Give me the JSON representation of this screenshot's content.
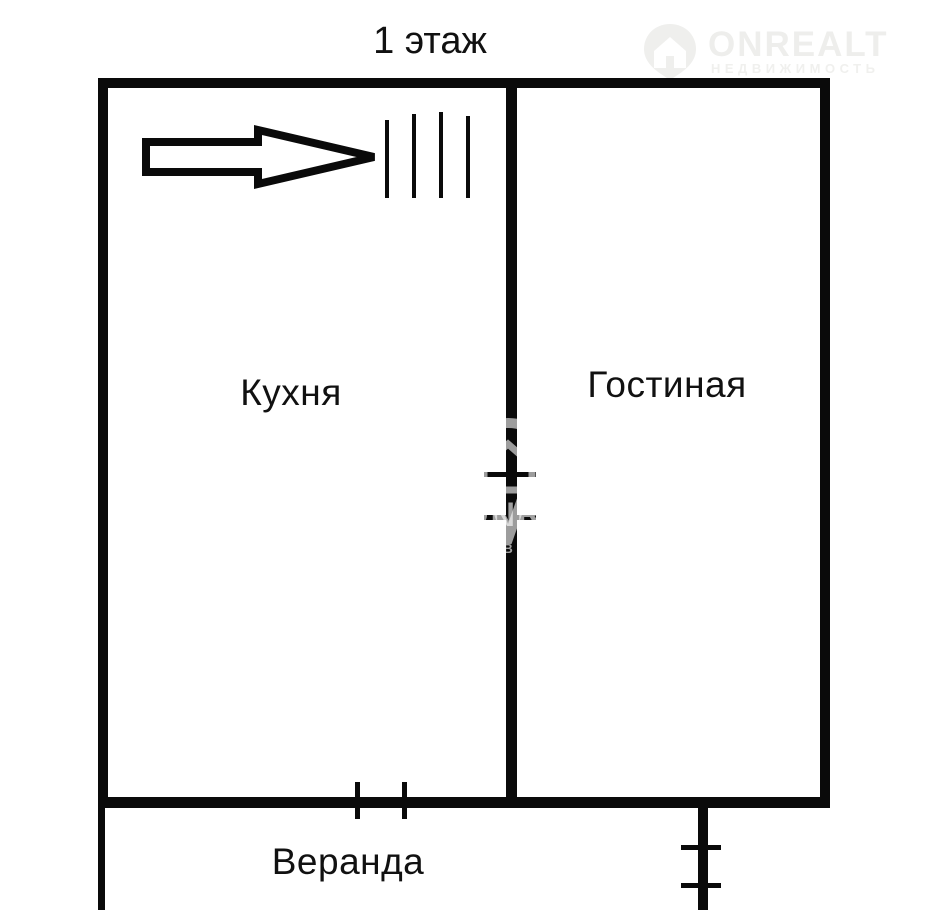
{
  "title": "1 этаж",
  "rooms": {
    "kitchen": "Кухня",
    "living_room": "Гостиная",
    "veranda": "Веранда"
  },
  "watermark": {
    "brand": "ONREALT",
    "subtitle": "НЕДВИЖИМОСТЬ"
  },
  "symbols": {
    "arrow": "entrance-direction-arrow",
    "hatch": "stairs-hatch-marks",
    "door_ticks": "door-opening-marks"
  },
  "colors": {
    "wall": "#0a0a0a",
    "background": "#ffffff",
    "watermark_light": "#eeeeec"
  }
}
